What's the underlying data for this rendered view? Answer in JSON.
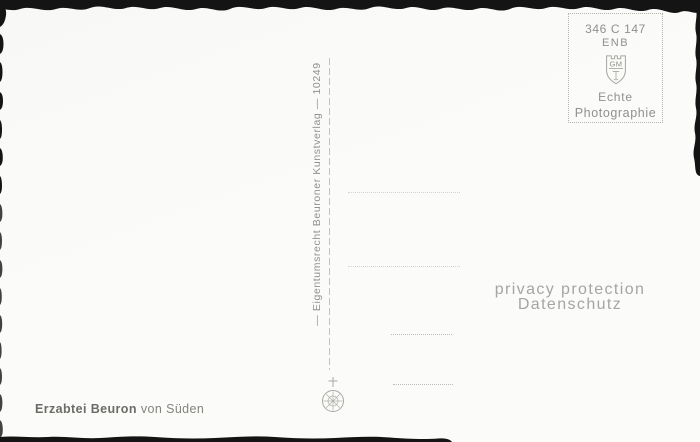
{
  "postcard": {
    "caption": {
      "title_bold": "Erzabtei Beuron",
      "title_rest": "von Süden"
    },
    "side_imprint": "— Eigentumsrecht Beuroner Kunstverlag — 10249",
    "stamp_box": {
      "code": "346 C 147",
      "code2": "ENB",
      "emblem_monogram": "GM",
      "label_line1": "Echte",
      "label_line2": "Photographie"
    },
    "watermark": {
      "line1": "privacy protection",
      "line2": "Datenschutz"
    }
  },
  "colors": {
    "scan_bg": "#141414",
    "card_bg": "#fbfbf9",
    "stamp_text": "#8f918f",
    "stamp_border": "#b4b4ae",
    "divider": "#c2c2be",
    "dotted_line_faint": "#d3d3cf",
    "dotted_line": "#bcbcb8",
    "watermark_text": "#a5a5a5",
    "caption_text": "#6b6b67",
    "caption_text_light": "#84847f",
    "emblem_stroke": "#a8a8a2"
  }
}
